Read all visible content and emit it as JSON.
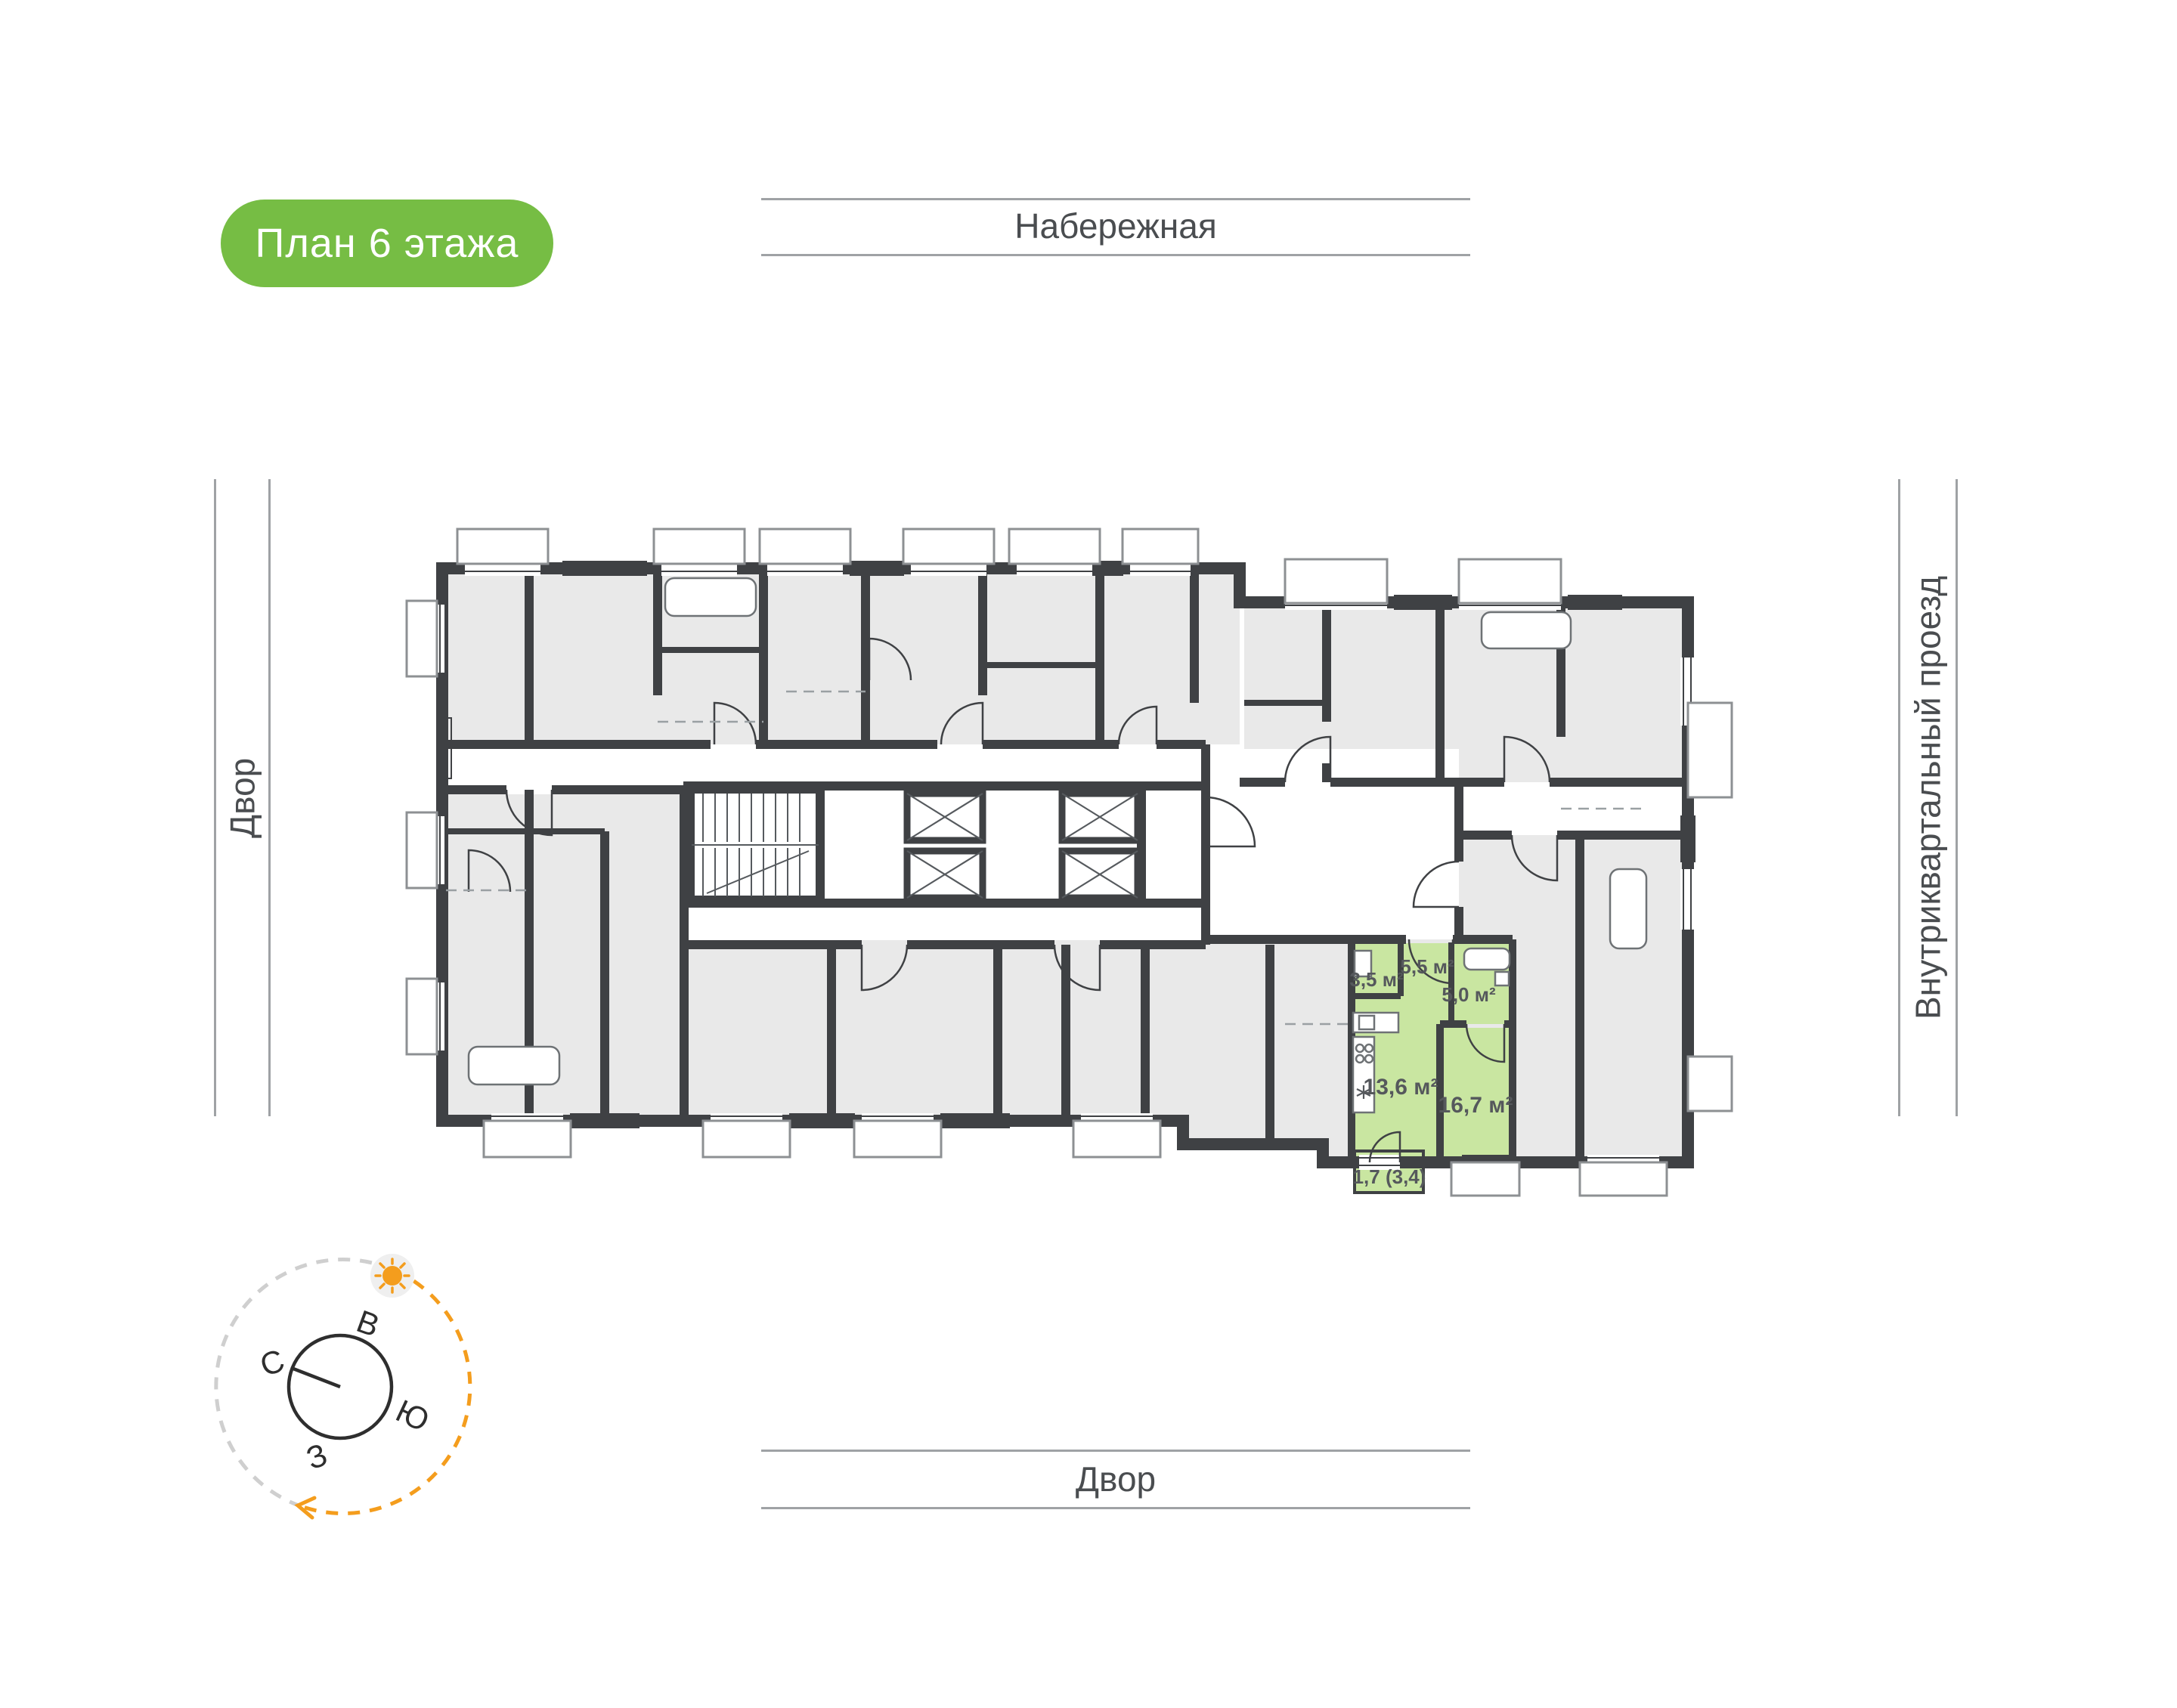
{
  "badge": {
    "label": "План 6 этажа",
    "bg": "#76BD44",
    "text_color": "#FFFFFF"
  },
  "streets": {
    "top": "Набережная",
    "left": "Двор",
    "right": "Внутриквартальный проезд",
    "bottom": "Двор"
  },
  "compass": {
    "north": "С",
    "east": "В",
    "south": "Ю",
    "west": "З",
    "sun_color": "#F49D1D",
    "arc_gray": "#cfcfcf",
    "arc_orange": "#F49D1D"
  },
  "plan": {
    "wall_color": "#3F4144",
    "room_fill": "#E9E9E9",
    "highlight_fill": "#C9E6A1",
    "label_color": "#55585C",
    "highlight": {
      "rooms": [
        {
          "name": "room-3-5",
          "area": "3,5 м²"
        },
        {
          "name": "hall-5-5",
          "area": "5,5 м²"
        },
        {
          "name": "bath-5-0",
          "area": "5,0 м²"
        },
        {
          "name": "kitchen-13-6",
          "area": "13,6 м²"
        },
        {
          "name": "room-16-7",
          "area": "16,7 м²"
        },
        {
          "name": "balcony-1-7",
          "area": "1,7 (3,4)"
        }
      ]
    }
  }
}
